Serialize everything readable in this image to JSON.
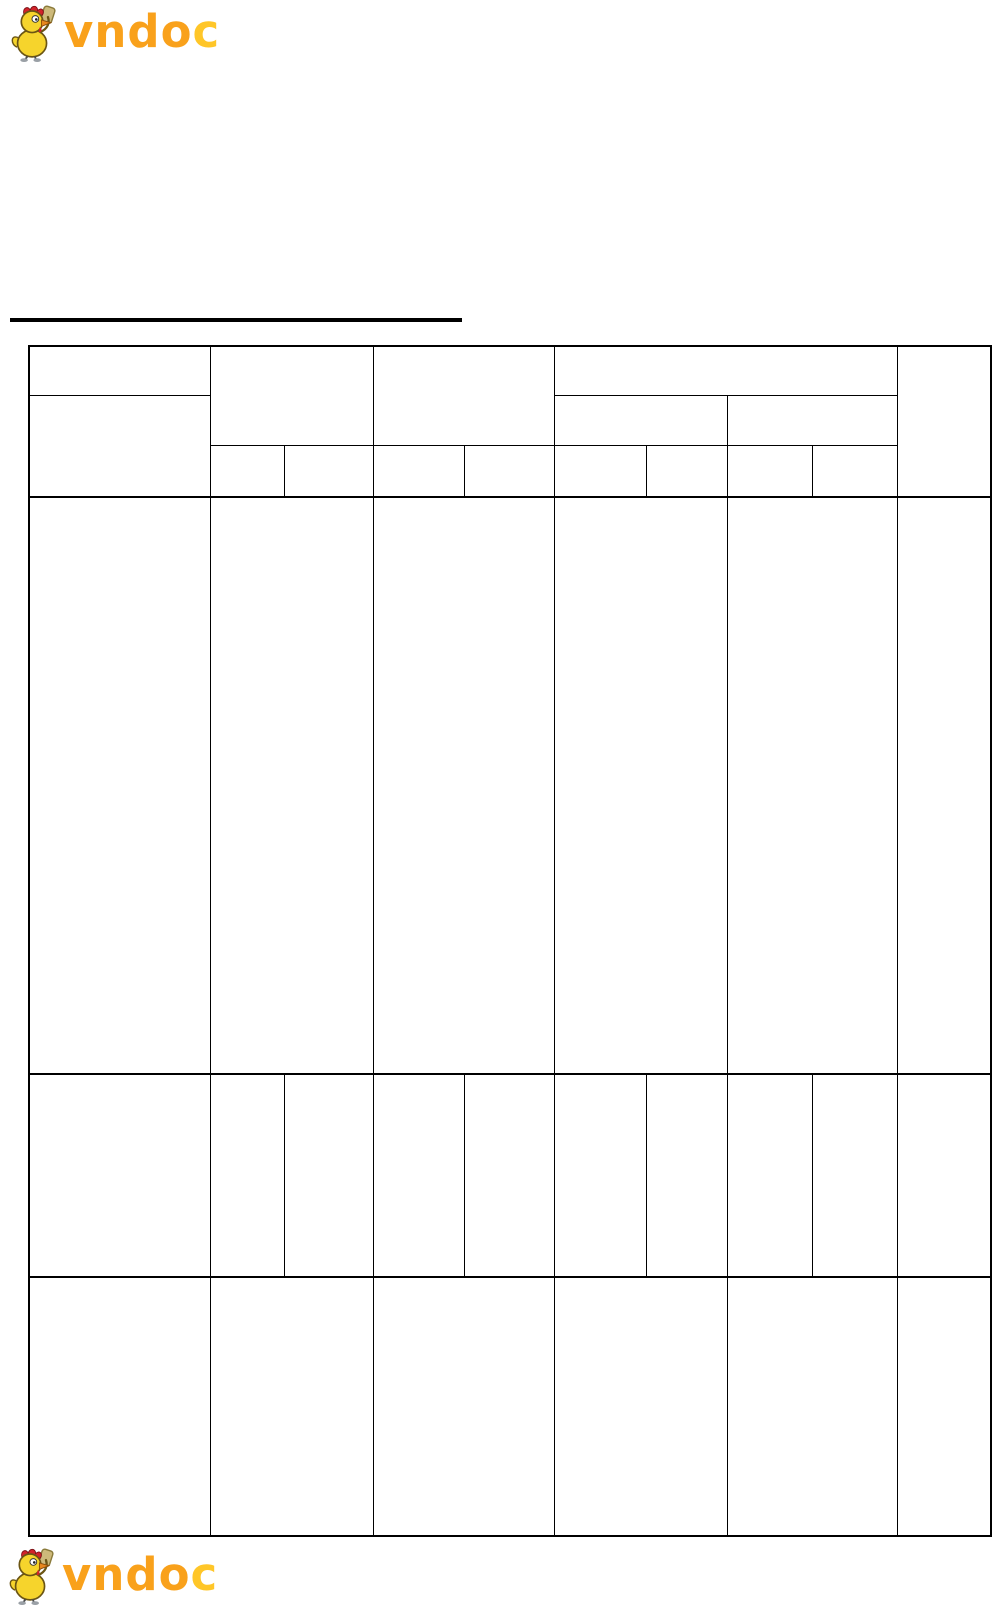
{
  "page": {
    "width_px": 993,
    "height_px": 1608,
    "background": "#ffffff"
  },
  "logo": {
    "text_main": "vndo",
    "text_accent": "c",
    "wordmark_color": "#F9A11B",
    "wordmark_accent_color": "#FFC628",
    "mascot_icon": "chicken-mascot-icon",
    "mascot_colors": {
      "body_yellow": "#F6D42C",
      "comb_red": "#D2232A",
      "beak_orange": "#E8871E",
      "outline": "#6B5514",
      "shoe_gray": "#9AA0A6",
      "accessory_khaki": "#CDB97A"
    }
  },
  "heading": {
    "text": "",
    "underline_present": true,
    "underline_color": "#000000"
  },
  "table": {
    "border_color": "#000000",
    "cell_text": "",
    "header": {
      "row_count": 3,
      "main_columns": 6,
      "leaf_sub_columns": 8,
      "col1_split_rows": 2,
      "col4_group_levels": 3
    },
    "body": {
      "row_count": 3,
      "row1_cells": 6,
      "row2_cells": 10,
      "row3_cells": 6
    }
  }
}
